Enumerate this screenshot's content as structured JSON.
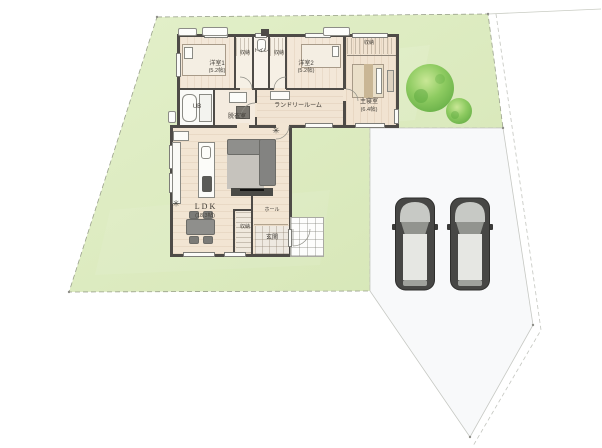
{
  "site": {
    "lawn_color": "#dfedc2",
    "lawn_color2": "#d6e6b6",
    "driveway_color": "#f8f9fa",
    "boundary_color": "#9aa18c",
    "tree_color_outer": "#64ad45",
    "tree_color_mid": "#8ecb61",
    "tree_color_inner": "#c9e796",
    "car_body_color": "#474745",
    "car_hood_color": "#c7c9c5",
    "car_windshield_color": "#92948f",
    "car_roof_color": "#e6e7e3"
  },
  "house": {
    "wall_color": "#4e4b47",
    "floor_color": "#f2e5d3"
  },
  "labels": {
    "bedroom1_name": "洋室1",
    "bedroom1_size": "(5.2帖)",
    "closet_left": "収納",
    "toilet": "トイレ",
    "closet_right": "収納",
    "bedroom2_name": "洋室2",
    "bedroom2_size": "(5.2帖)",
    "master_closet": "収納",
    "master_name": "主寝室",
    "master_size": "(6.4帖)",
    "bath": "UB",
    "dressing": "脱衣室",
    "laundry": "ランドリールーム",
    "ldk_name": "LDK",
    "ldk_size": "(18.3帖)",
    "hall": "ホール",
    "ldk_storage": "収納",
    "entrance": "玄関"
  },
  "icons": {
    "plant": "✳"
  }
}
